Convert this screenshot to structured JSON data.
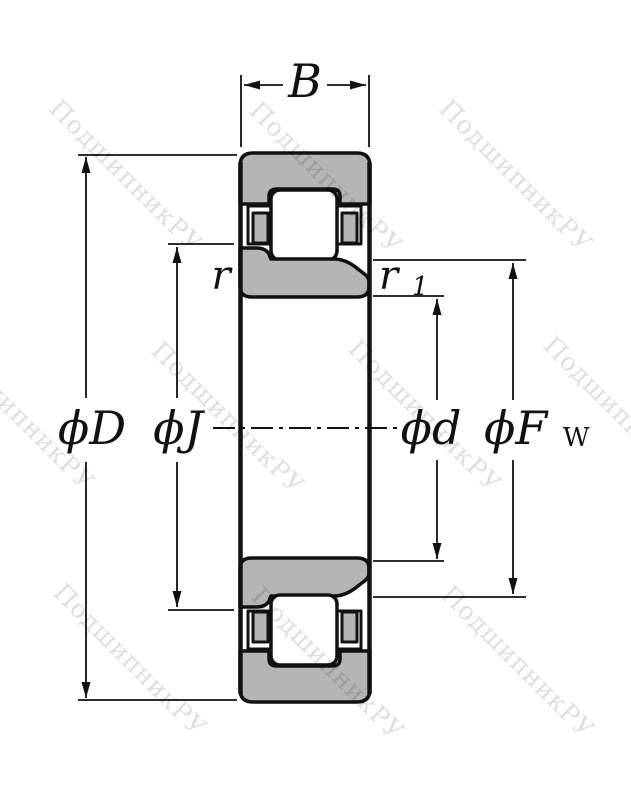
{
  "drawing": {
    "watermark_text": "ПодшипникРУ",
    "labels": {
      "width": "B",
      "chamfer_outer": "r",
      "chamfer_inner_main": "r",
      "chamfer_inner_sub": "1",
      "outer_diameter": "ϕD",
      "rib_diameter": "ϕJ",
      "bore_diameter": "ϕd",
      "raceway_diameter_main": "ϕF",
      "raceway_diameter_sub": "W"
    },
    "colors": {
      "ring_fill": "#b5b5b5",
      "outline": "#111111",
      "background": "#ffffff"
    }
  }
}
